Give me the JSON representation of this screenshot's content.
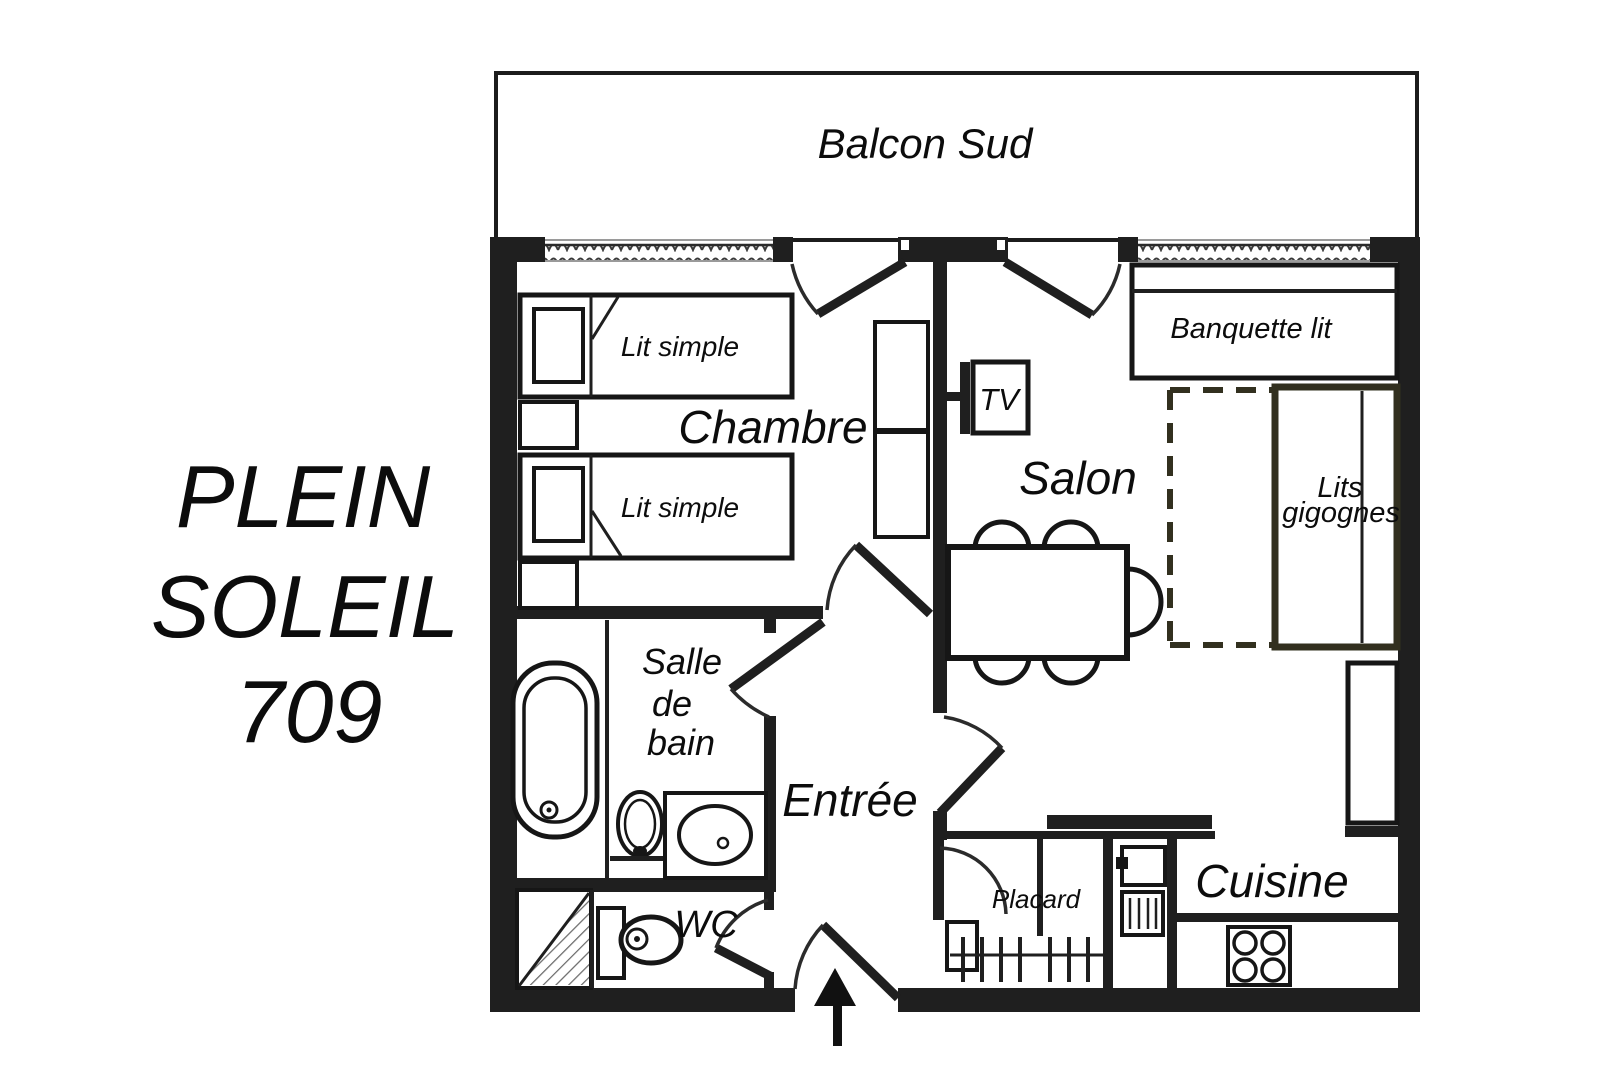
{
  "title": {
    "line1": "PLEIN",
    "line2": "SOLEIL",
    "line3": "709"
  },
  "labels": {
    "balcony": "Balcon Sud",
    "bedroom": "Chambre",
    "living": "Salon",
    "entry": "Entrée",
    "wc": "WC",
    "closet": "Placard",
    "kitchen": "Cuisine",
    "bath1": "Salle",
    "bath2": "de",
    "bath3": "bain"
  },
  "furniture": {
    "bed1": "Lit simple",
    "bed2": "Lit simple",
    "tv": "TV",
    "sofa_bed": "Banquette lit",
    "nest1": "Lits",
    "nest2": "gigognes"
  },
  "colors": {
    "wall": "#1f1f1f",
    "nesting_bed_accent": "#32301f",
    "background": "#ffffff"
  }
}
